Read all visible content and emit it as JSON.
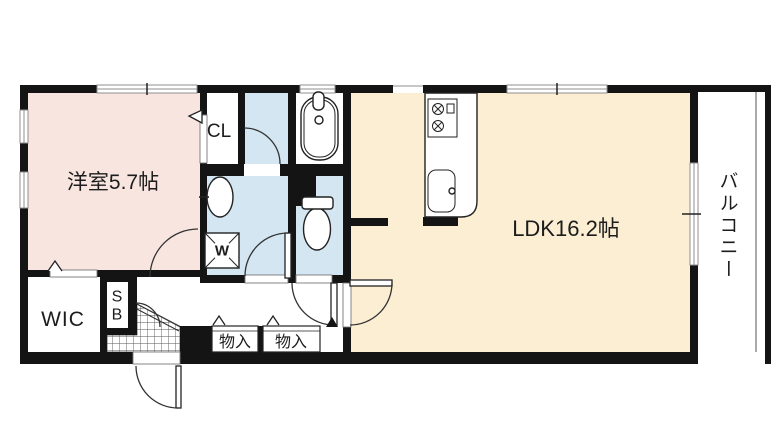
{
  "floorplan": {
    "labels": {
      "western_room": "洋室5.7帖",
      "ldk": "LDK16.2帖",
      "balcony": "バルコニー",
      "wic": "WIC",
      "closet": "CL",
      "shoe_box": "SB",
      "storage_1": "物入",
      "storage_2": "物入",
      "washer": "W"
    },
    "fixture_icons": [
      "bathtub-icon",
      "toilet-icon",
      "washbasin-icon",
      "washing-machine-icon",
      "kitchen-stove-icon",
      "kitchen-sink-icon",
      "entrance-tile",
      "door-swing-arc",
      "window-slider"
    ],
    "colors": {
      "western_room": "#f8e5e0",
      "ldk": "#fbeed3",
      "wet_area": "#d3e6f2",
      "wall": "#141414",
      "window": "#8f8f8f",
      "tile_line": "#555555"
    }
  }
}
